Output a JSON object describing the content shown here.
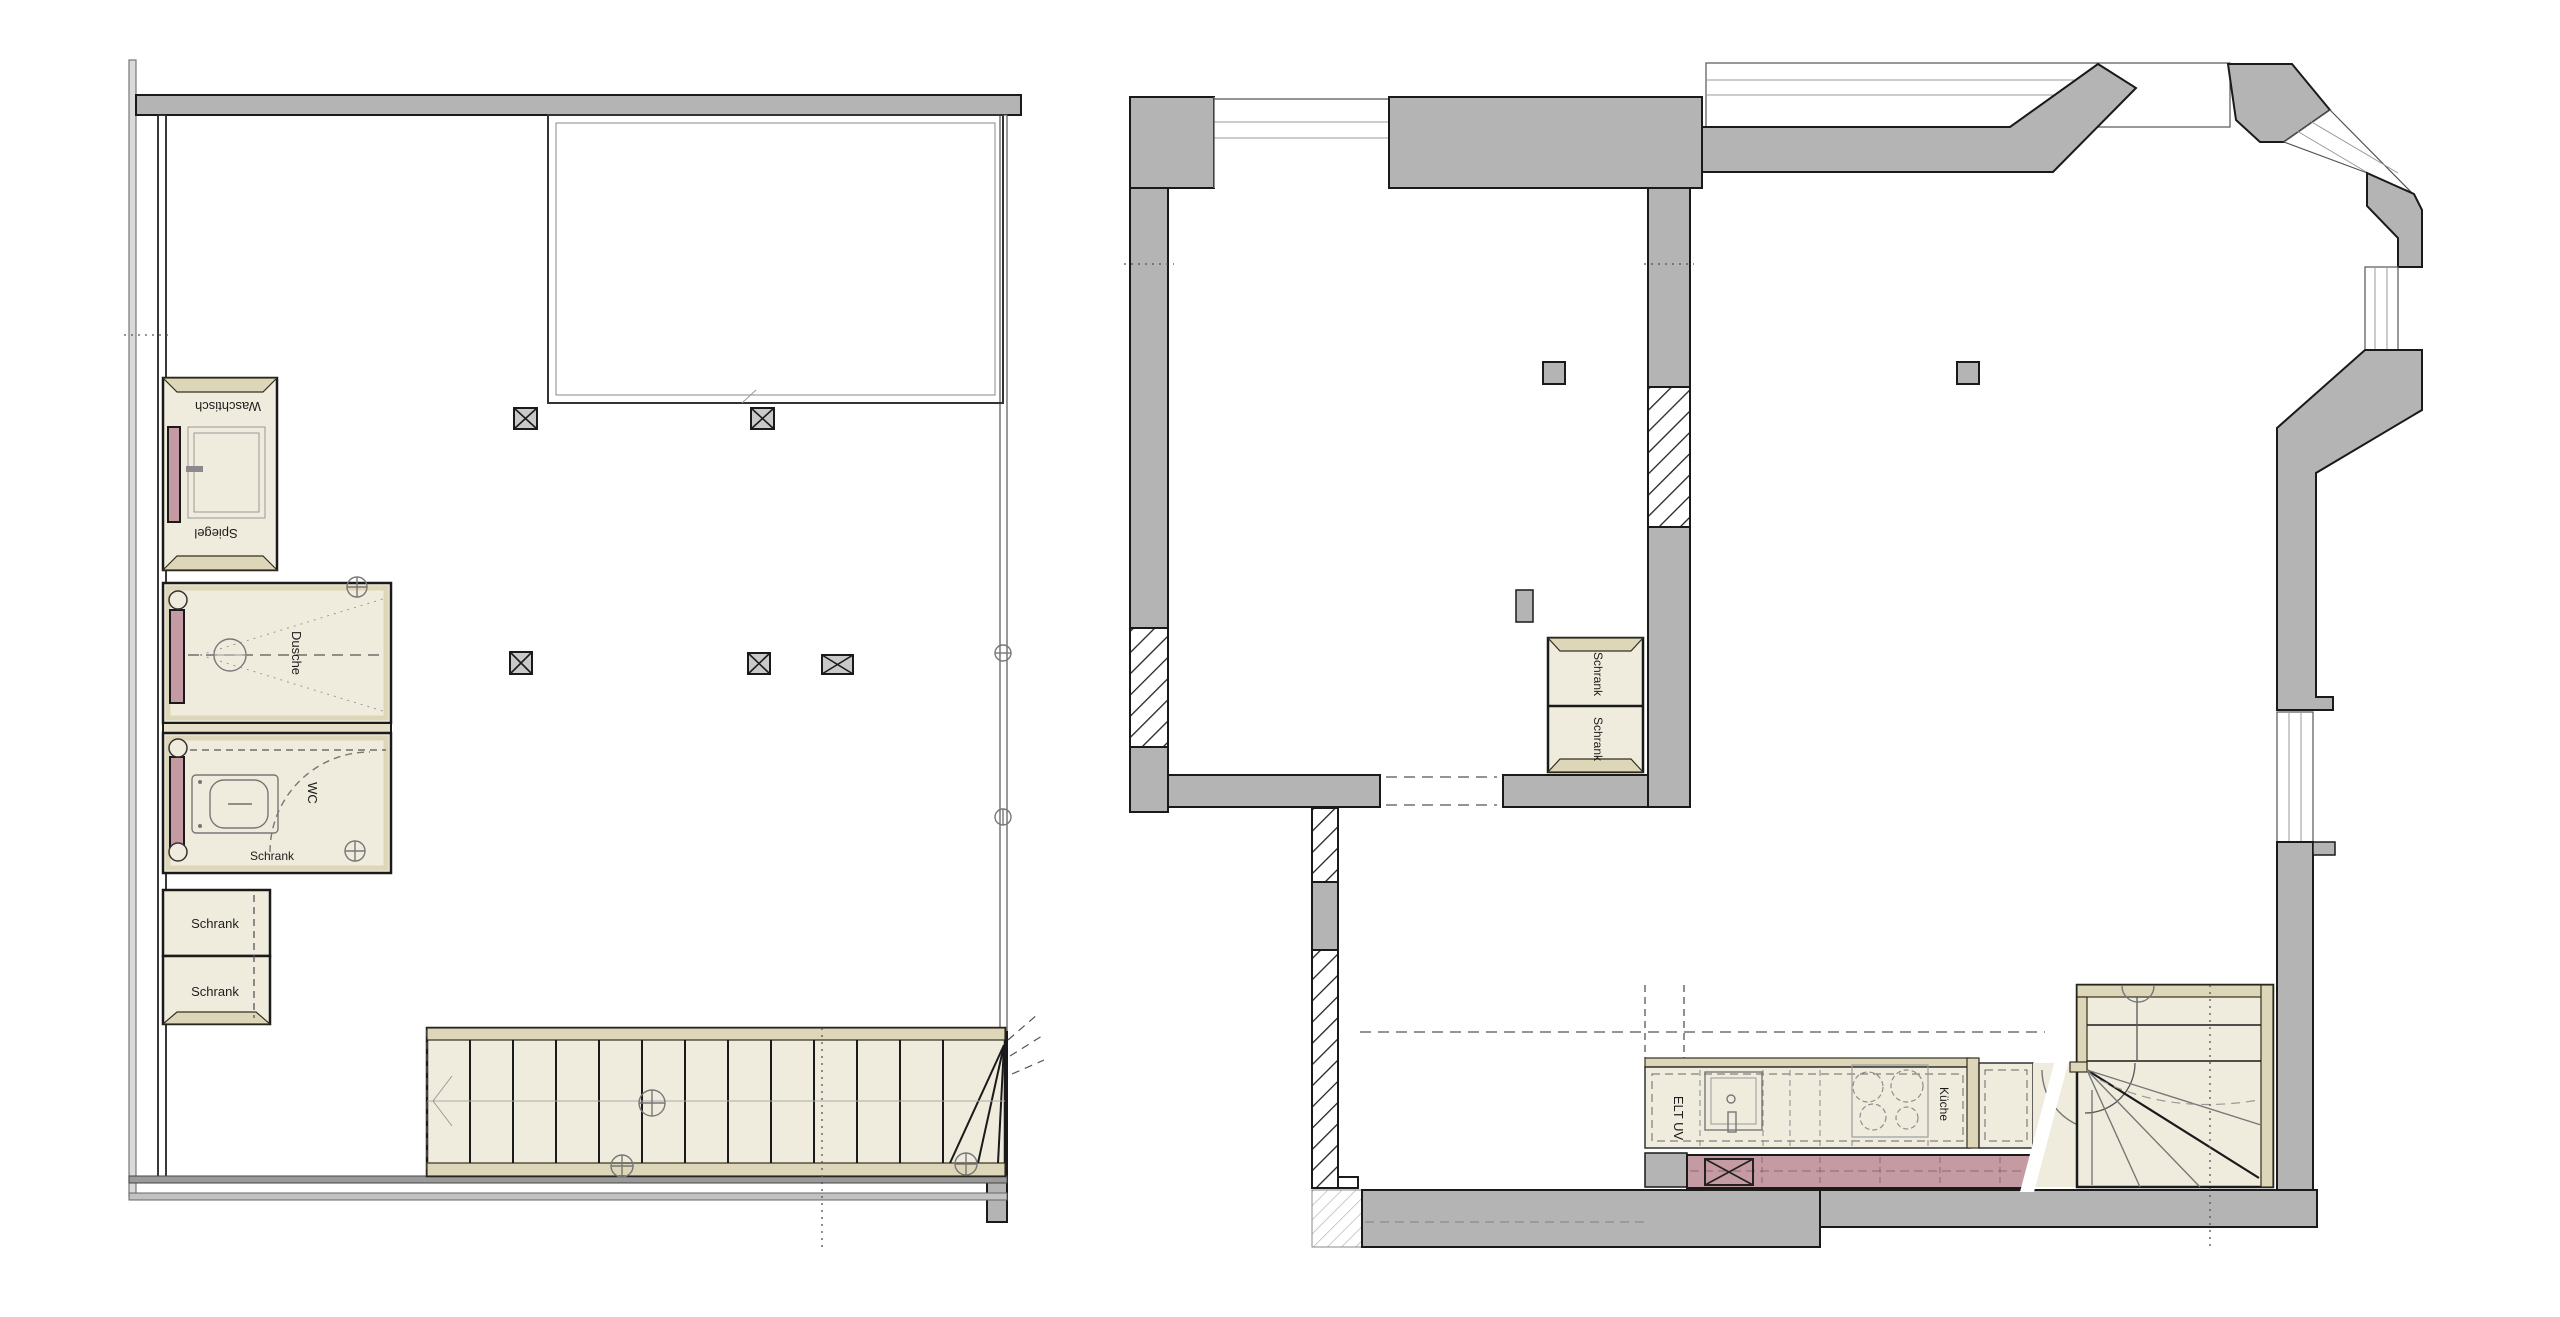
{
  "colors": {
    "paper_white": "#ffffff",
    "wall_gray": "#b4b4b4",
    "fixture_cream": "#f0ecdd",
    "fixture_tan": "#ded6b8",
    "accent_pink": "#c59ba3",
    "line_dark": "#1a1a1a"
  },
  "left_plan": {
    "labels": {
      "waschtisch": "Waschtisch",
      "spiegel": "Spiegel",
      "dusche": "Dusche",
      "wc": "WC",
      "wc_schrank": "Schrank",
      "schrank_upper": "Schrank",
      "schrank_lower": "Schrank"
    }
  },
  "right_plan": {
    "labels": {
      "schrank_upper": "Schrank",
      "schrank_lower": "Schrank",
      "kueche": "Küche",
      "elt_uv": "ELT UV"
    }
  }
}
